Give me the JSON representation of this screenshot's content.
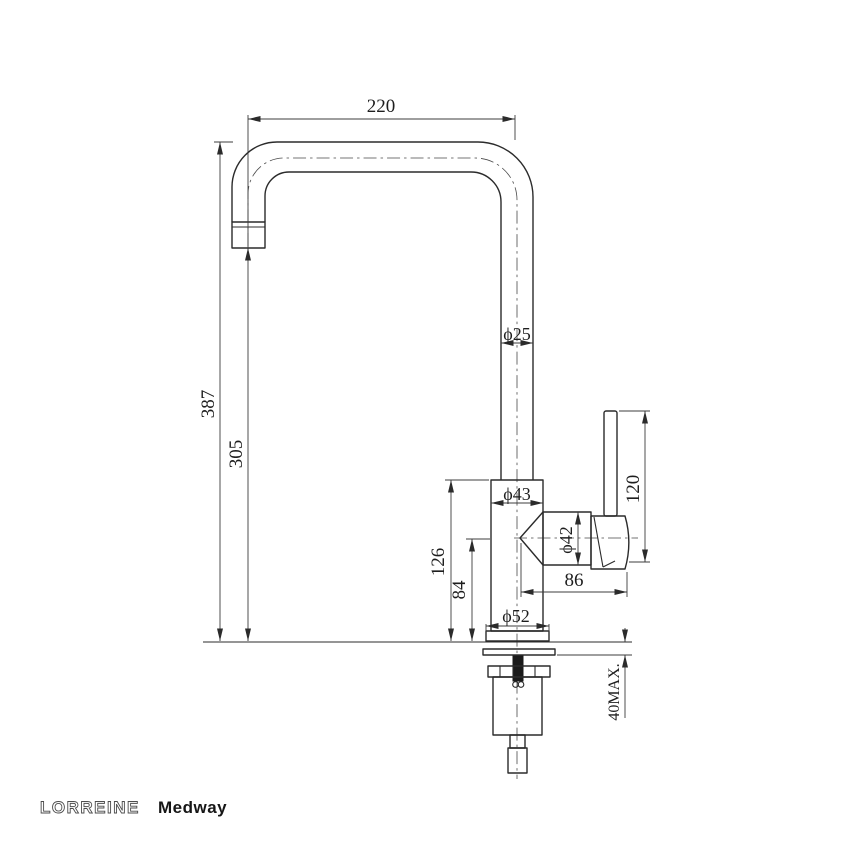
{
  "page": {
    "background": "#ffffff",
    "line_color": "#2b2b2b"
  },
  "drawing": {
    "type": "technical-dimension-drawing",
    "subject": "kitchen mixer tap, side elevation",
    "brand": "LORREINE",
    "model": "Medway",
    "dimensions": {
      "spout_reach": "220",
      "overall_height": "387",
      "spout_outlet_height": "305",
      "spout_tube_diameter": "ϕ25",
      "body_diameter": "ϕ43",
      "valve_diameter": "ϕ42",
      "base_diameter": "ϕ52",
      "body_top_height": "126",
      "valve_center_height": "84",
      "valve_length": "86",
      "handle_length": "120",
      "deck_thickness_max": "40MAX."
    }
  }
}
